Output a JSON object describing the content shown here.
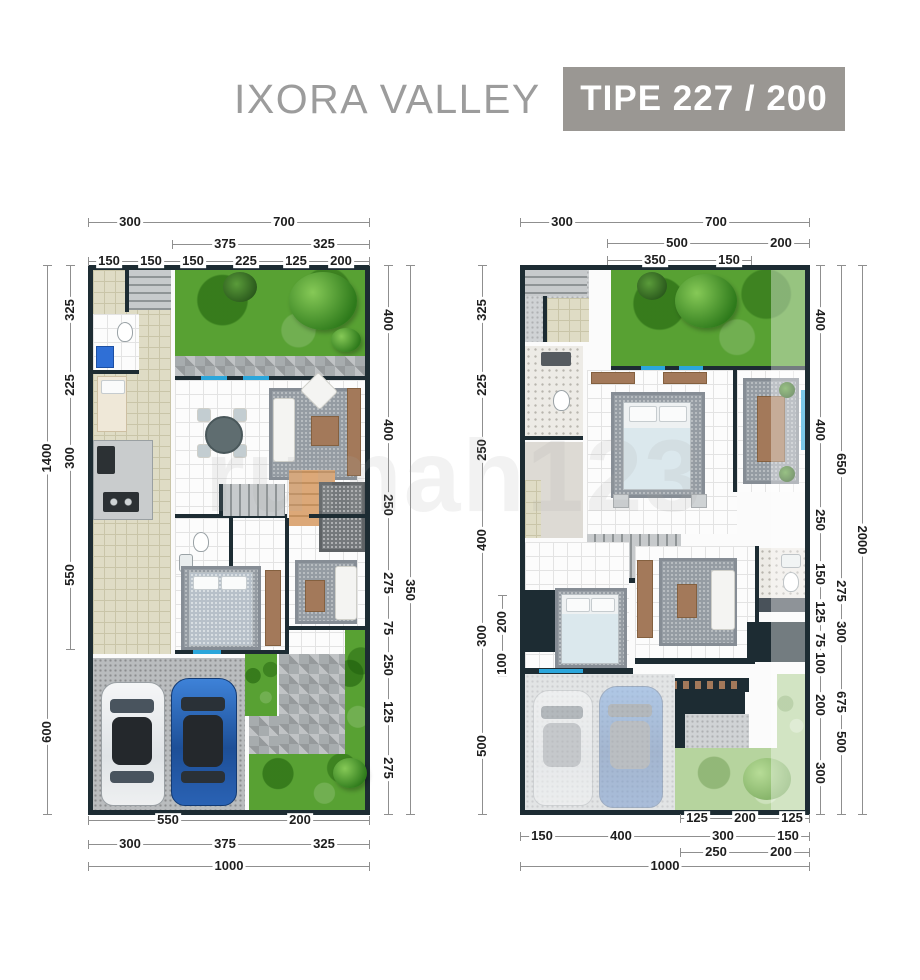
{
  "header": {
    "title": "IXORA VALLEY",
    "badge": "TIPE 227 / 200"
  },
  "watermark": "rumah123",
  "plan1": {
    "top": {
      "r1": [
        "300",
        "700"
      ],
      "r2": [
        "375",
        "325"
      ],
      "r3": [
        "150",
        "150",
        "150",
        "225",
        "125",
        "200"
      ]
    },
    "left": {
      "outer": [
        "1400",
        "600"
      ],
      "inner": [
        "325",
        "225",
        "300",
        "550"
      ]
    },
    "right": {
      "inner": [
        "400",
        "400",
        "250",
        "275",
        "75",
        "250",
        "125",
        "275"
      ],
      "outer": [
        "350"
      ]
    },
    "bottom": {
      "r1": [
        "550",
        "200"
      ],
      "r2": [
        "300",
        "375",
        "325"
      ],
      "total": "1000"
    }
  },
  "plan2": {
    "top": {
      "r1": [
        "300",
        "700"
      ],
      "r2": [
        "500",
        "200"
      ],
      "r3": [
        "350",
        "150"
      ]
    },
    "left": {
      "outer": [
        "325",
        "225",
        "250",
        "400",
        "300",
        "500"
      ],
      "inner": [
        "200",
        "100"
      ]
    },
    "right": {
      "inner": [
        "400",
        "400",
        "250",
        "150",
        "125",
        "75",
        "100",
        "200",
        "300"
      ],
      "mid": [
        "650",
        "275",
        "300",
        "675",
        "500"
      ],
      "outer": [
        "2000"
      ]
    },
    "bottom": {
      "r1": [
        "125",
        "200",
        "125"
      ],
      "r2": [
        "150",
        "400",
        "300",
        "150"
      ],
      "r3": [
        "250",
        "200"
      ],
      "total": "1000"
    }
  }
}
